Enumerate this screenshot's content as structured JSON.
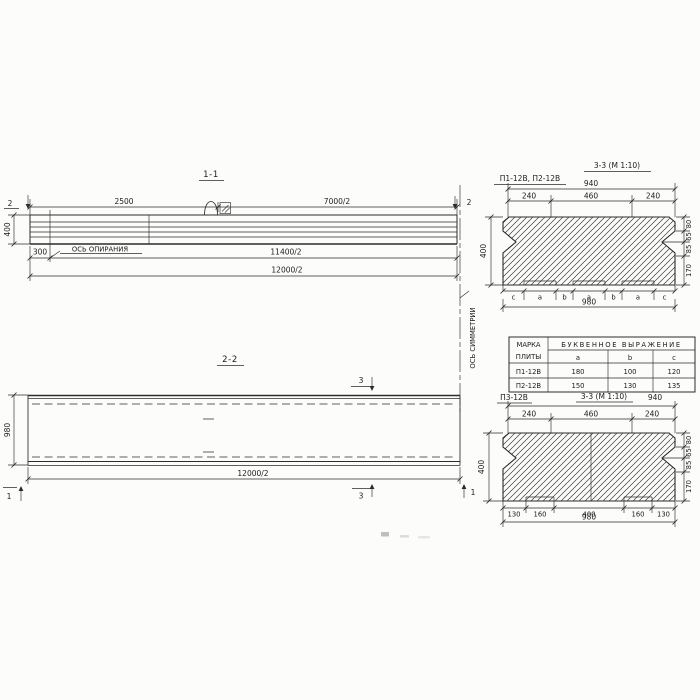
{
  "s11": {
    "title": "1-1",
    "mark": "2",
    "d2500": "2500",
    "d7000": "7000/2",
    "d400": "400",
    "d300": "300",
    "axis": "ОСЬ ОПИРАНИЯ",
    "d11400": "11400/2",
    "d12000": "12000/2"
  },
  "s33t": {
    "label": "П1-12В, П2-12В",
    "title": "3-3 (М 1:10)",
    "d940": "940",
    "top": [
      "240",
      "460",
      "240"
    ],
    "d400": "400",
    "right": [
      "80",
      "65",
      "85",
      "170"
    ],
    "letters": [
      "c",
      "a",
      "b",
      "a",
      "b",
      "a",
      "c"
    ],
    "d980": "980"
  },
  "table": {
    "h1a": "МАРКА",
    "h1b": "ПЛИТЫ",
    "h2": "БУКВЕННОЕ ВЫРАЖЕНИЕ",
    "cols": [
      "a",
      "b",
      "c"
    ],
    "rows": [
      [
        "П1-12В",
        "180",
        "100",
        "120"
      ],
      [
        "П2-12В",
        "150",
        "130",
        "135"
      ]
    ]
  },
  "s22": {
    "title": "2-2",
    "mark3": "3",
    "mark1": "1",
    "d980": "980",
    "d12000": "12000/2",
    "axis": "ОСЬ СИММЕТРИИ"
  },
  "s33b": {
    "label": "П3-12В",
    "title": "3-3 (М 1:10)",
    "d940": "940",
    "top": [
      "240",
      "460",
      "240"
    ],
    "d400": "400",
    "right": [
      "80",
      "65",
      "85",
      "170"
    ],
    "bottom": [
      "130",
      "160",
      "400",
      "160",
      "130"
    ],
    "d980": "980"
  }
}
